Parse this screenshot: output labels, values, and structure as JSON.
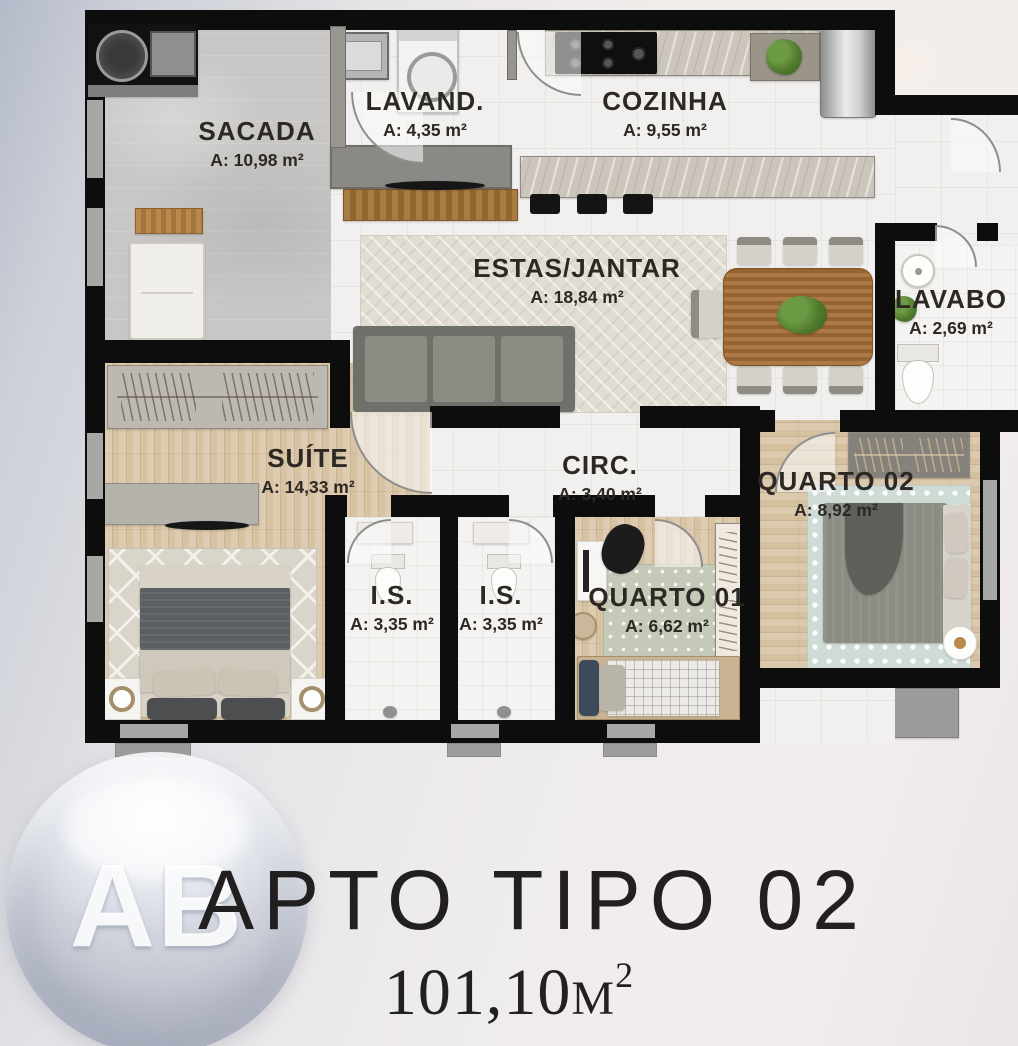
{
  "plan": {
    "rooms": {
      "sacada": {
        "name": "SACADA",
        "area": "A: 10,98 m²"
      },
      "lavand": {
        "name": "LAVAND.",
        "area": "A: 4,35 m²"
      },
      "cozinha": {
        "name": "COZINHA",
        "area": "A: 9,55 m²"
      },
      "estas_jantar": {
        "name": "ESTAS/JANTAR",
        "area": "A: 18,84 m²"
      },
      "lavabo": {
        "name": "LAVABO",
        "area": "A: 2,69 m²"
      },
      "suite": {
        "name": "SUÍTE",
        "area": "A: 14,33 m²"
      },
      "circ": {
        "name": "CIRC.",
        "area": "A: 3,40 m²"
      },
      "quarto02": {
        "name": "QUARTO 02",
        "area": "A: 8,92 m²"
      },
      "is1": {
        "name": "I.S.",
        "area": "A: 3,35 m²"
      },
      "is2": {
        "name": "I.S.",
        "area": "A: 3,35 m²"
      },
      "quarto01": {
        "name": "QUARTO 01",
        "area": "A: 6,62 m²"
      }
    }
  },
  "footer": {
    "title": "APTO TIPO 02",
    "area_value": "101,10",
    "area_unit": "M",
    "area_sup": "2"
  },
  "logo": {
    "letters": "AB"
  },
  "colors": {
    "wall": "#0d0d0d",
    "label_text": "#2c2823",
    "logo_sphere": "#aeb9cc"
  }
}
